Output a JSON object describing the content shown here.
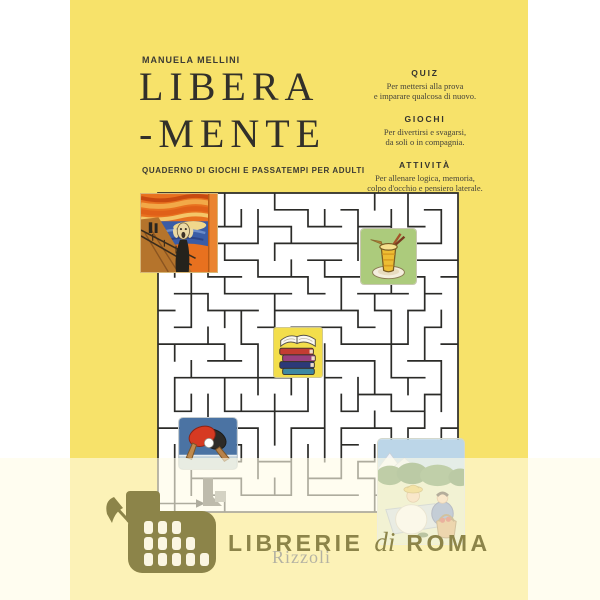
{
  "cover": {
    "author": "MANUELA MELLINI",
    "title_line1": "LIBERA",
    "title_line2": "-MENTE",
    "subtitle": "QUADERNO DI GIOCHI E PASSATEMPI PER ADULTI",
    "publisher_logo": "Rizzoli",
    "features": [
      {
        "heading": "QUIZ",
        "line1": "Per mettersi alla prova",
        "line2": "e imparare qualcosa di nuovo."
      },
      {
        "heading": "GIOCHI",
        "line1": "Per divertirsi e svagarsi,",
        "line2": "da soli o in compagnia."
      },
      {
        "heading": "ATTIVITÀ",
        "line1": "Per allenare logica, memoria,",
        "line2": "colpo d'occhio e pensiero laterale."
      }
    ],
    "maze_images": [
      "the-scream-painting",
      "ice-cream-sundae",
      "stack-of-books",
      "table-tennis-paddles",
      "picnic-scene"
    ],
    "colors": {
      "cover_yellow": "#f7e26a",
      "title_ink": "#32302a",
      "maze_wall": "#2b2b28"
    }
  },
  "watermark": {
    "librerie": "LIBRERIE",
    "di": "di",
    "roma": "ROMA",
    "icon": "colosseum",
    "color": "#8c8449"
  }
}
